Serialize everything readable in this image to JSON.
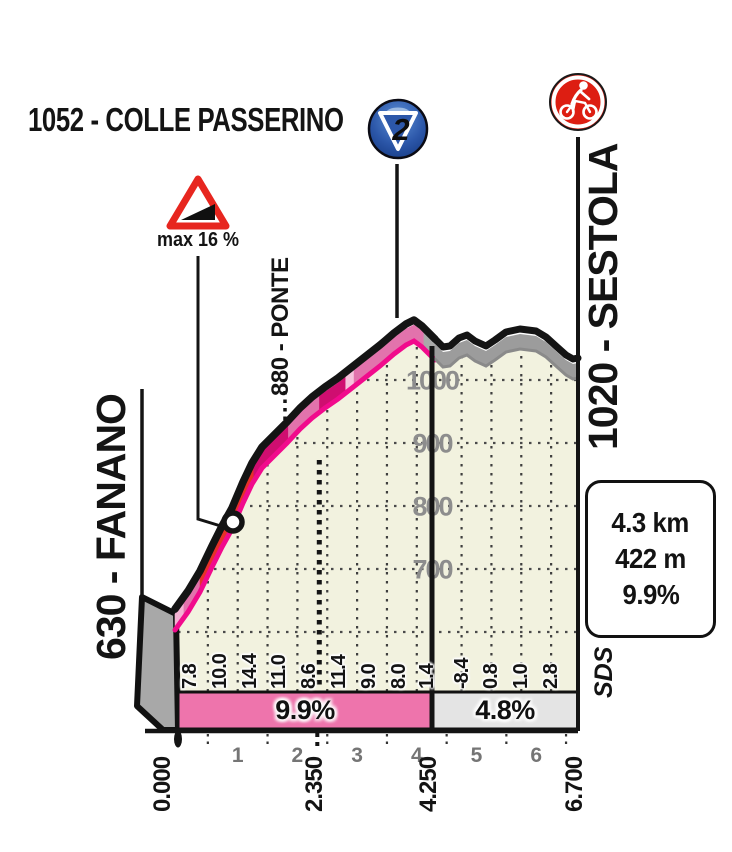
{
  "title": {
    "text": "1052 - COLLE PASSERINO"
  },
  "category_badge": {
    "number": "2"
  },
  "max_gradient": {
    "label": "max 16 %"
  },
  "place_labels": {
    "start": "630 - FANANO",
    "intermediate": "880 - PONTE",
    "finish": "1020 - SESTOLA"
  },
  "summary_box": {
    "distance": "4.3 km",
    "elevation_gain": "422 m",
    "avg_gradient": "9.9%"
  },
  "brand": {
    "logo": "SDS"
  },
  "sector_bars": [
    {
      "label": "9.9%",
      "from_km": 0,
      "to_km": 4.25,
      "color": "#ee74ac"
    },
    {
      "label": "4.8%",
      "from_km": 4.25,
      "to_km": 6.7,
      "color": "#e4e4e4"
    }
  ],
  "axis": {
    "km_labels": [
      {
        "text": "0.000",
        "km": 0
      },
      {
        "text": "2.350",
        "km": 2.35
      },
      {
        "text": "4.250",
        "km": 4.25
      },
      {
        "text": "6.700",
        "km": 6.7
      }
    ],
    "km_numbers": [
      1,
      2,
      3,
      4,
      5,
      6
    ],
    "elevation_ticks": [
      1000,
      900,
      800,
      700
    ]
  },
  "gradient_values": [
    {
      "text": "7.8",
      "km": 0.2
    },
    {
      "text": "10.0",
      "km": 0.7
    },
    {
      "text": "14.4",
      "km": 1.2
    },
    {
      "text": "11.0",
      "km": 1.7
    },
    {
      "text": "8.6",
      "km": 2.2
    },
    {
      "text": "11.4",
      "km": 2.7
    },
    {
      "text": "9.0",
      "km": 3.2
    },
    {
      "text": "8.0",
      "km": 3.7
    },
    {
      "text": "1.4",
      "km": 4.17
    },
    {
      "text": "-8.4",
      "km": 4.75
    },
    {
      "text": "0.8",
      "km": 5.25
    },
    {
      "text": "1.0",
      "km": 5.75
    },
    {
      "text": "2.8",
      "km": 6.25
    }
  ],
  "colors": {
    "road_pink": "#e273ac",
    "road_red": "#e63128",
    "road_magenta": "#cf0e70",
    "road_stripe": "#f3b2d3",
    "road_gray": "#9c9c9c",
    "road_edge_black": "#141414",
    "road_under_magenta": "#f10b8c",
    "chart_fill": "#f2f2df",
    "bar_pink": "#ee74ac",
    "bar_gray": "#e4e4e4",
    "badge_blue": "#2c57a9",
    "icon_red": "#dd1e12",
    "tick_gray": "#8d8d8d"
  },
  "road_segments": [
    {
      "from_km": 0.0,
      "to_km": 0.15,
      "color": "#f3b2d3"
    },
    {
      "from_km": 0.15,
      "to_km": 0.42,
      "color": "#e273ac"
    },
    {
      "from_km": 0.42,
      "to_km": 1.32,
      "color": "#e63128"
    },
    {
      "from_km": 1.32,
      "to_km": 1.9,
      "color": "#cf0e70"
    },
    {
      "from_km": 1.9,
      "to_km": 2.42,
      "color": "#e273ac"
    },
    {
      "from_km": 2.42,
      "to_km": 2.86,
      "color": "#cf0e70"
    },
    {
      "from_km": 2.86,
      "to_km": 3.0,
      "color": "#f6c3dc"
    },
    {
      "from_km": 3.0,
      "to_km": 4.17,
      "color": "#e273ac"
    },
    {
      "from_km": 4.17,
      "to_km": 4.31,
      "color": "#a9a9a9"
    }
  ],
  "chart_data": {
    "type": "area",
    "title": "Colle Passerino climb profile (Giro stage finale)",
    "xlabel": "distance (km)",
    "ylabel": "elevation (m)",
    "x_range_km": [
      0,
      6.7
    ],
    "y_ticks_m": [
      700,
      800,
      900,
      1000
    ],
    "grid": "dotted, vertical every 0.5 km, horizontal every 100 m",
    "elevation_profile": [
      [
        0.0,
        630
      ],
      [
        0.5,
        669
      ],
      [
        1.0,
        719
      ],
      [
        1.5,
        791
      ],
      [
        2.0,
        846
      ],
      [
        2.35,
        880
      ],
      [
        2.5,
        889
      ],
      [
        3.0,
        946
      ],
      [
        3.5,
        991
      ],
      [
        4.0,
        1031
      ],
      [
        4.25,
        1052
      ],
      [
        4.5,
        1015
      ],
      [
        4.7,
        1000
      ],
      [
        4.9,
        1022
      ],
      [
        5.1,
        1012
      ],
      [
        5.3,
        1040
      ],
      [
        5.6,
        1038
      ],
      [
        5.9,
        1020
      ],
      [
        6.1,
        1008
      ],
      [
        6.3,
        1000
      ],
      [
        6.5,
        1006
      ],
      [
        6.7,
        1020
      ]
    ],
    "gradient_percent_per_half_km": [
      7.8,
      10.0,
      14.4,
      11.0,
      8.6,
      11.4,
      9.0,
      8.0,
      1.4,
      -8.4,
      0.8,
      1.0,
      2.8
    ],
    "sector_average_gradients": [
      {
        "sector": "0.000-4.250 km",
        "gradient": "9.9%"
      },
      {
        "sector": "4.250-6.700 km",
        "gradient": "4.8%"
      }
    ],
    "landmarks": [
      {
        "name": "Fanano",
        "km": 0,
        "elevation_m": 630,
        "role": "climb start"
      },
      {
        "name": "Ponte",
        "km": 2.35,
        "elevation_m": 880,
        "role": "intermediate point"
      },
      {
        "name": "Colle Passerino",
        "km": 4.25,
        "elevation_m": 1052,
        "role": "KOM summit, category 2"
      },
      {
        "name": "Sestola",
        "km": 6.7,
        "elevation_m": 1020,
        "role": "finish"
      }
    ],
    "max_gradient_percent": 16,
    "climb_length_km": 4.3,
    "climb_gain_m": 422,
    "climb_avg_percent": 9.9
  }
}
